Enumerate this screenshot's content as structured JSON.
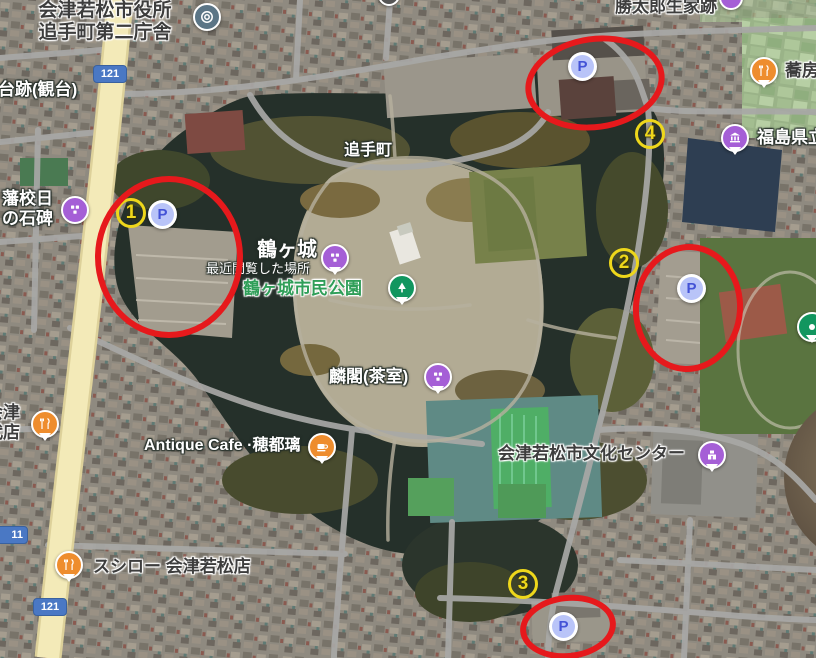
{
  "app": {
    "type": "satellite-map-screenshot",
    "area": "鶴ヶ城 / 会津若松"
  },
  "colors": {
    "annotation_red": "#e6191c",
    "number_yellow": "#eed71b",
    "parking_fill": "#b9c4f8",
    "parking_letter": "#4352d6",
    "pin_purple": "#a55fd6",
    "pin_orange": "#ee8d2e",
    "pin_green": "#11965f",
    "pin_slate": "#5b7586",
    "route_badge_blue": "#4a78c4",
    "park_label_green": "#2f9e58"
  },
  "parking_letter": "P",
  "numbered_markers": [
    {
      "value": "1"
    },
    {
      "value": "2"
    },
    {
      "value": "3"
    },
    {
      "value": "4"
    }
  ],
  "route_badges": [
    {
      "number": "121"
    },
    {
      "number": "11"
    },
    {
      "number": "121"
    }
  ],
  "pois": {
    "city_hall": {
      "line1": "会津若松市役所",
      "line2": "追手町第二庁舎",
      "icon": "government-office"
    },
    "katsutaro_site": {
      "text": "勝太郎生家跡"
    },
    "observation_site": {
      "text": "台跡(観台)"
    },
    "hanko_monument": {
      "line1": "藩校日",
      "line2": "の石碑",
      "icon": "monument"
    },
    "otemachi": {
      "text": "追手町"
    },
    "tsurugajo": {
      "text": "鶴ヶ城",
      "subtext": "最近閲覧した場所",
      "icon": "castle"
    },
    "citizen_park": {
      "text": "鶴ヶ城市民公園",
      "icon": "park-tree"
    },
    "rinkaku": {
      "text": "麟閣(茶室)",
      "icon": "historic"
    },
    "antique_cafe": {
      "text": "Antique Cafe ·穂都璃",
      "icon": "cafe"
    },
    "culture_center": {
      "text": "会津若松市文化センター",
      "icon": "public-hall"
    },
    "sushiro": {
      "text": "スシロー 会津若松店",
      "icon": "restaurant"
    },
    "soba_restaurant": {
      "text": "蕎房",
      "icon": "restaurant"
    },
    "fukushima_prefectural": {
      "text": "福島県立",
      "icon": "museum"
    },
    "aizu_shop": {
      "line1": "会津",
      "line2": "代店",
      "icon": "restaurant"
    }
  }
}
